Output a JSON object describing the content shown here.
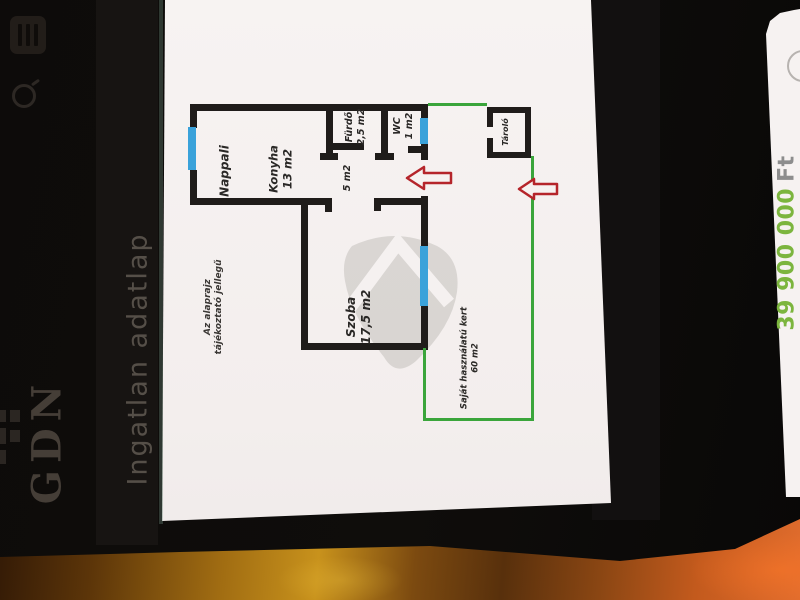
{
  "app": {
    "brand": "GDN",
    "title": "Ingatlan adatlap",
    "price_value": "39 900 000",
    "price_currency": "Ft"
  },
  "floor_plan": {
    "disclaimer": {
      "line1": "Az alaprajz",
      "line2": "tájékoztató jellegű"
    },
    "rooms": {
      "nappali": {
        "name": "Nappali"
      },
      "konyha": {
        "name": "Konyha",
        "area": "13 m2"
      },
      "furdo": {
        "name": "Fürdő",
        "area": "2,5 m2"
      },
      "wc": {
        "name": "WC",
        "area": "1 m2"
      },
      "eloter": {
        "area": "5 m2"
      },
      "szoba": {
        "name": "Szoba",
        "area": "17,5 m2"
      },
      "tarolo": {
        "name": "Tároló"
      },
      "kert": {
        "name": "Saját használatú kert",
        "area": "60 m2"
      }
    }
  },
  "icons": {
    "menu": "menu-grid-icon",
    "search": "search-icon",
    "qr": "qr-code-icon",
    "entrance_arrows": "red-entrance-arrow-icon"
  },
  "colors": {
    "wall": "#1f1c1a",
    "window_blue": "#3aa2da",
    "garden_green": "#3aa53b",
    "arrow_red": "#b5252b",
    "price_green": "#7cb53e",
    "table_amber": "#c8921c"
  }
}
